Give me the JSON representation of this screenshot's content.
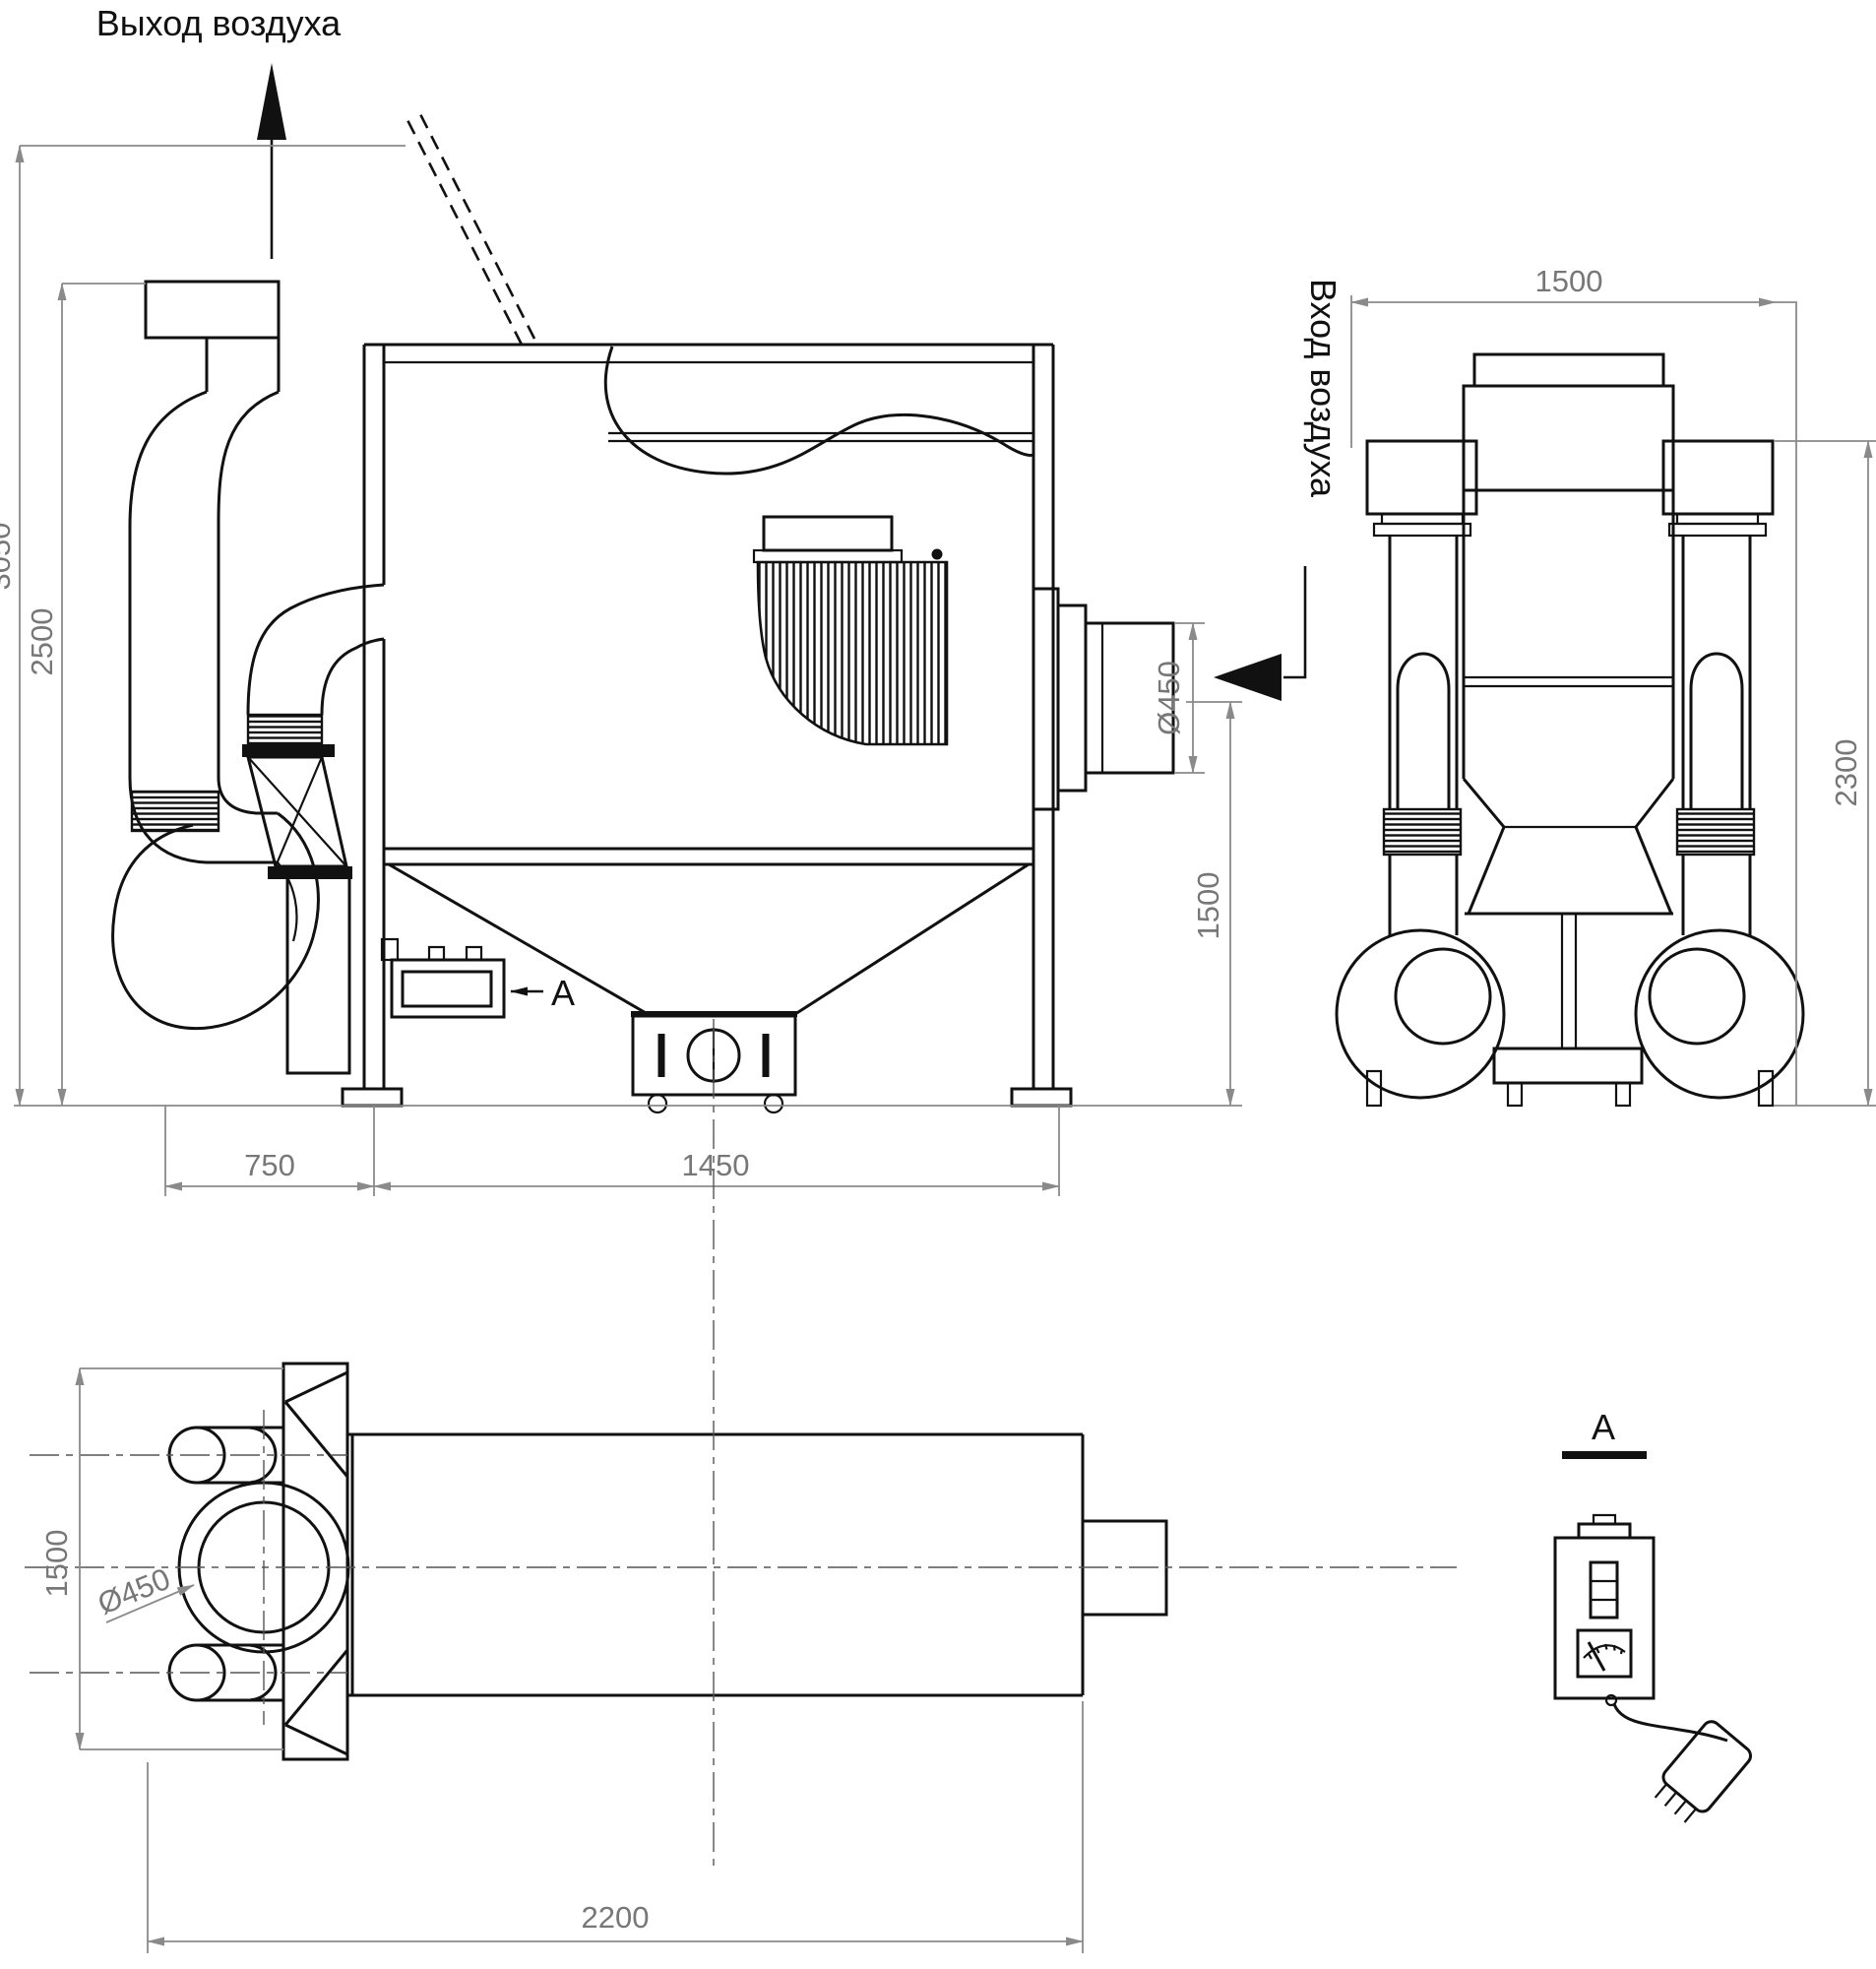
{
  "labels": {
    "air_outlet": "Выход воздуха",
    "air_inlet": "Вход воздуха"
  },
  "side_view": {
    "dim_total_height": "3050",
    "dim_stack_height": "2500",
    "dim_inlet_diameter": "Ø450",
    "dim_inlet_height": "1500",
    "dim_fan_width": "750",
    "dim_body_width": "1450",
    "section_marker": "A"
  },
  "front_view": {
    "dim_width": "1500",
    "dim_height": "2300"
  },
  "top_view": {
    "dim_depth": "1500",
    "dim_outlet_diameter": "Ø450",
    "dim_total_length": "2200"
  },
  "detail_a": {
    "title": "A"
  }
}
